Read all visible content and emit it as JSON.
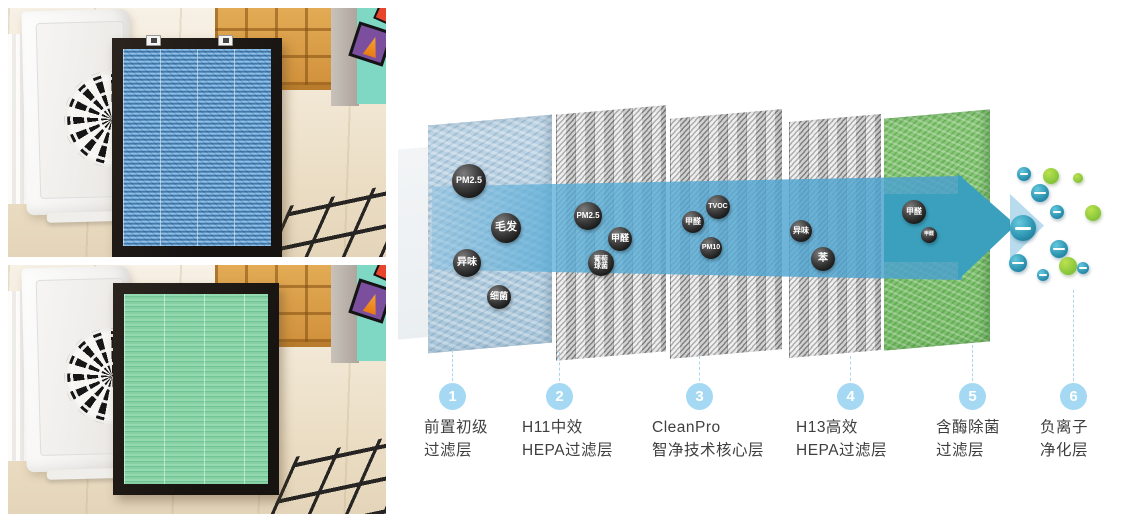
{
  "colors": {
    "accent_blue": "#58acd6",
    "arrow_teal": "#3aa0bd",
    "cone_light": "#b8dcee",
    "panel_blue": "#b7cfe0",
    "panel_green": "#83c573",
    "step_circle": "#a5d9f3",
    "label_text": "#3f3f3f",
    "ion_teal": "#2f97b4",
    "ion_green": "#8cc93c"
  },
  "photos": [
    {
      "name": "blue-filter-photo"
    },
    {
      "name": "green-filter-photo"
    }
  ],
  "diagram": {
    "steps": [
      {
        "num": "1",
        "line1": "前置初级",
        "line2": "过滤层"
      },
      {
        "num": "2",
        "line1": "H11中效",
        "line2": "HEPA过滤层"
      },
      {
        "num": "3",
        "line1": "CleanPro",
        "line2": "智净技术核心层"
      },
      {
        "num": "4",
        "line1": "H13高效",
        "line2": "HEPA过滤层"
      },
      {
        "num": "5",
        "line1": "含酶除菌",
        "line2": "过滤层"
      },
      {
        "num": "6",
        "line1": "负离子",
        "line2": "净化层"
      }
    ],
    "particles": [
      {
        "label": "PM2.5",
        "x": 469,
        "y": 181,
        "r": 17,
        "fs": 9
      },
      {
        "label": "毛发",
        "x": 506,
        "y": 228,
        "r": 15,
        "fs": 11
      },
      {
        "label": "异味",
        "x": 467,
        "y": 263,
        "r": 14,
        "fs": 10
      },
      {
        "label": "细菌",
        "x": 499,
        "y": 297,
        "r": 12,
        "fs": 9
      },
      {
        "label": "PM2.5",
        "x": 588,
        "y": 216,
        "r": 14,
        "fs": 8
      },
      {
        "label": "甲醛",
        "x": 620,
        "y": 239,
        "r": 12,
        "fs": 9
      },
      {
        "label": "葡萄\n球菌",
        "x": 601,
        "y": 263,
        "r": 13,
        "fs": 7
      },
      {
        "label": "TVOC",
        "x": 718,
        "y": 207,
        "r": 12,
        "fs": 7
      },
      {
        "label": "甲醛",
        "x": 693,
        "y": 222,
        "r": 11,
        "fs": 8
      },
      {
        "label": "PM10",
        "x": 711,
        "y": 248,
        "r": 11,
        "fs": 7
      },
      {
        "label": "异味",
        "x": 801,
        "y": 231,
        "r": 11,
        "fs": 8
      },
      {
        "label": "苯",
        "x": 823,
        "y": 259,
        "r": 12,
        "fs": 10
      },
      {
        "label": "甲醛",
        "x": 914,
        "y": 212,
        "r": 12,
        "fs": 8
      },
      {
        "label": "甲醛",
        "x": 929,
        "y": 235,
        "r": 8,
        "fs": 5
      }
    ],
    "ions": [
      {
        "type": "negative",
        "x": 1024,
        "y": 174,
        "r": 7
      },
      {
        "type": "clean",
        "x": 1051,
        "y": 176,
        "r": 8
      },
      {
        "type": "clean",
        "x": 1078,
        "y": 178,
        "r": 5
      },
      {
        "type": "negative",
        "x": 1040,
        "y": 193,
        "r": 9
      },
      {
        "type": "negative",
        "x": 1057,
        "y": 212,
        "r": 7
      },
      {
        "type": "clean",
        "x": 1093,
        "y": 213,
        "r": 8
      },
      {
        "type": "negative",
        "x": 1023,
        "y": 228,
        "r": 13
      },
      {
        "type": "negative",
        "x": 1059,
        "y": 249,
        "r": 9
      },
      {
        "type": "negative",
        "x": 1018,
        "y": 263,
        "r": 9
      },
      {
        "type": "clean",
        "x": 1068,
        "y": 266,
        "r": 9
      },
      {
        "type": "negative",
        "x": 1043,
        "y": 275,
        "r": 6
      },
      {
        "type": "negative",
        "x": 1083,
        "y": 268,
        "r": 6
      }
    ]
  }
}
